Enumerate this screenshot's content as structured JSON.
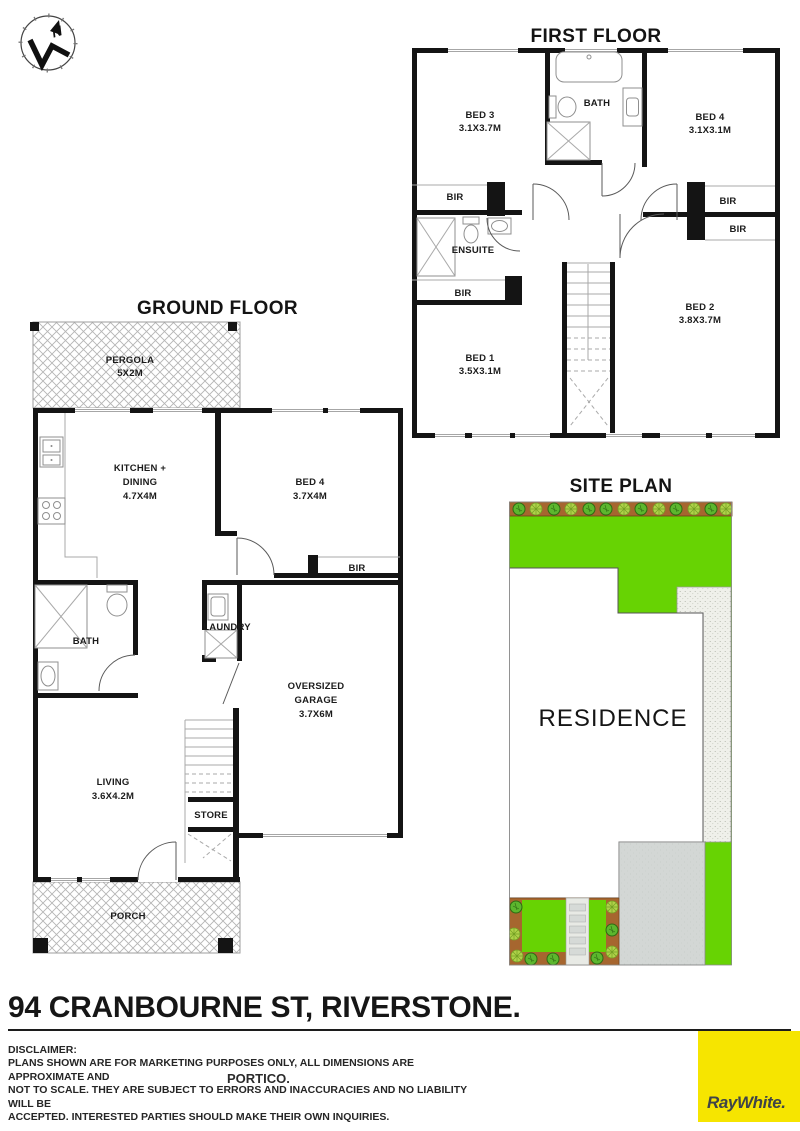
{
  "compass": {
    "north_label": "N"
  },
  "first_floor": {
    "title": "FIRST FLOOR",
    "labels": {
      "bed3": "BED 3",
      "bed3_dims": "3.1X3.7M",
      "bath": "BATH",
      "bed4": "BED 4",
      "bed4_dims": "3.1X3.1M",
      "bir": "BIR",
      "ensuite": "ENSUITE",
      "bed1": "BED 1",
      "bed1_dims": "3.5X3.1M",
      "bed2": "BED 2",
      "bed2_dims": "3.8X3.7M"
    }
  },
  "ground_floor": {
    "title": "GROUND FLOOR",
    "labels": {
      "pergola": "PERGOLA",
      "pergola_dims": "5X2M",
      "kitchen_line1": "KITCHEN +",
      "kitchen_line2": "DINING",
      "kitchen_dims": "4.7X4M",
      "bed4": "BED 4",
      "bed4_dims": "3.7X4M",
      "bir": "BIR",
      "bath": "BATH",
      "laundry": "LAUNDRY",
      "garage_line1": "OVERSIZED",
      "garage_line2": "GARAGE",
      "garage_dims": "3.7X6M",
      "living": "LIVING",
      "living_dims": "3.6X4.2M",
      "store": "STORE",
      "porch": "PORCH"
    }
  },
  "site_plan": {
    "title": "SITE PLAN",
    "residence": "RESIDENCE"
  },
  "footer": {
    "address": "94 CRANBOURNE ST, RIVERSTONE.",
    "portico": "PORTICO.",
    "disclaimer_heading": "DISCLAIMER:",
    "disclaimer_lines": [
      "PLANS SHOWN ARE FOR MARKETING PURPOSES ONLY, ALL DIMENSIONS ARE APPROXIMATE AND",
      "NOT TO SCALE. THEY ARE SUBJECT TO ERRORS AND INACCURACIES AND NO LIABILITY WILL BE",
      "ACCEPTED. INTERESTED PARTIES SHOULD MAKE THEIR OWN INQUIRIES."
    ],
    "brand": "RayWhite."
  },
  "colors": {
    "grass": "#67D303",
    "garden_soil": "#A6662F",
    "driveway": "#D3D7D5",
    "footpath": "#EFF0EA",
    "wall": "#141414",
    "brand_bg": "#F6E500",
    "brand_text": "#3E4448"
  }
}
